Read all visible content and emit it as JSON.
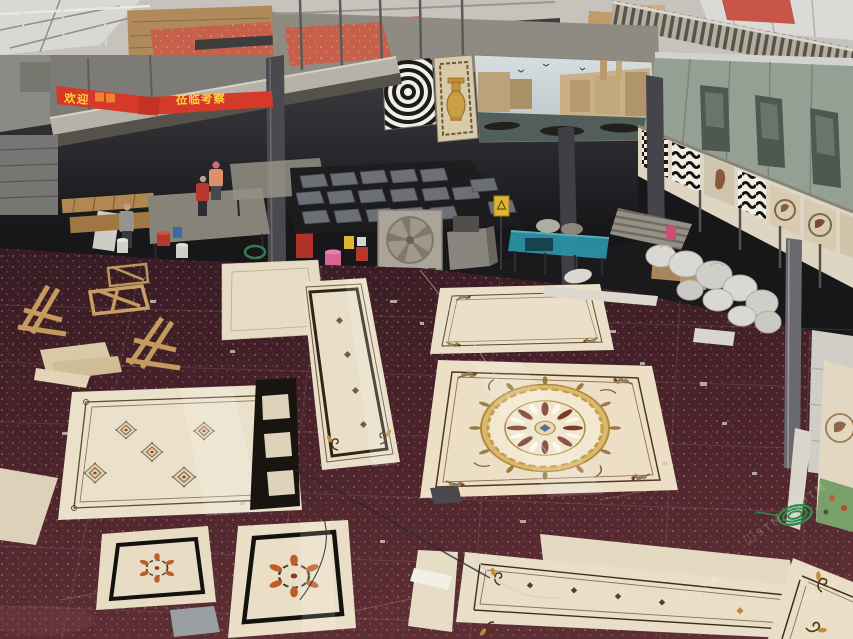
{
  "meta": {
    "scene": "Elevated photograph of a stone-medallion factory workshop: cream waterjet marble medallion panels laid out on a dark maroon floor, mezzanine with mosaic murals above, workers and machines under the mezzanine"
  },
  "banner": {
    "text_left": "欢迎",
    "text_right": "莅临考察",
    "background": "#d5392a",
    "text_color": "#ffd23e"
  },
  "watermark": {
    "text": "STM",
    "color": "#ffffff",
    "opacity": 0.16
  },
  "palette": {
    "floor_maroon": "#4c232b",
    "marble_cream": "#e9dfc8",
    "medallion_gold": "#d9b96c",
    "panel_border_dark": "#4a3823",
    "machine_teal": "#2b91a5",
    "mosaic_red": "#c7604a",
    "prefab_wall_green": "#95a094",
    "banner_red": "#d5392a",
    "wood": "#c49a5e",
    "sack_white": "#d9d8d2"
  },
  "objects": {
    "murals": [
      "zebra op-art mosaic",
      "golden vase mosaic",
      "venice canal mosaic"
    ],
    "floor_panels": [
      "large gold circle medallion panel",
      "corner floral panel",
      "vertical runner panel",
      "five diamond motif panel",
      "black border strip",
      "small wreath panel",
      "large wreath panel",
      "long bottom runner",
      "corner scroll tile"
    ],
    "equipment": [
      "industrial exhaust fan",
      "teal conveyor machine",
      "grey tile stacks",
      "wooden shipping crates",
      "white packing sacks",
      "green wire coil"
    ],
    "people": [
      "worker grey shirt",
      "worker red shirt",
      "worker pink cap"
    ]
  }
}
